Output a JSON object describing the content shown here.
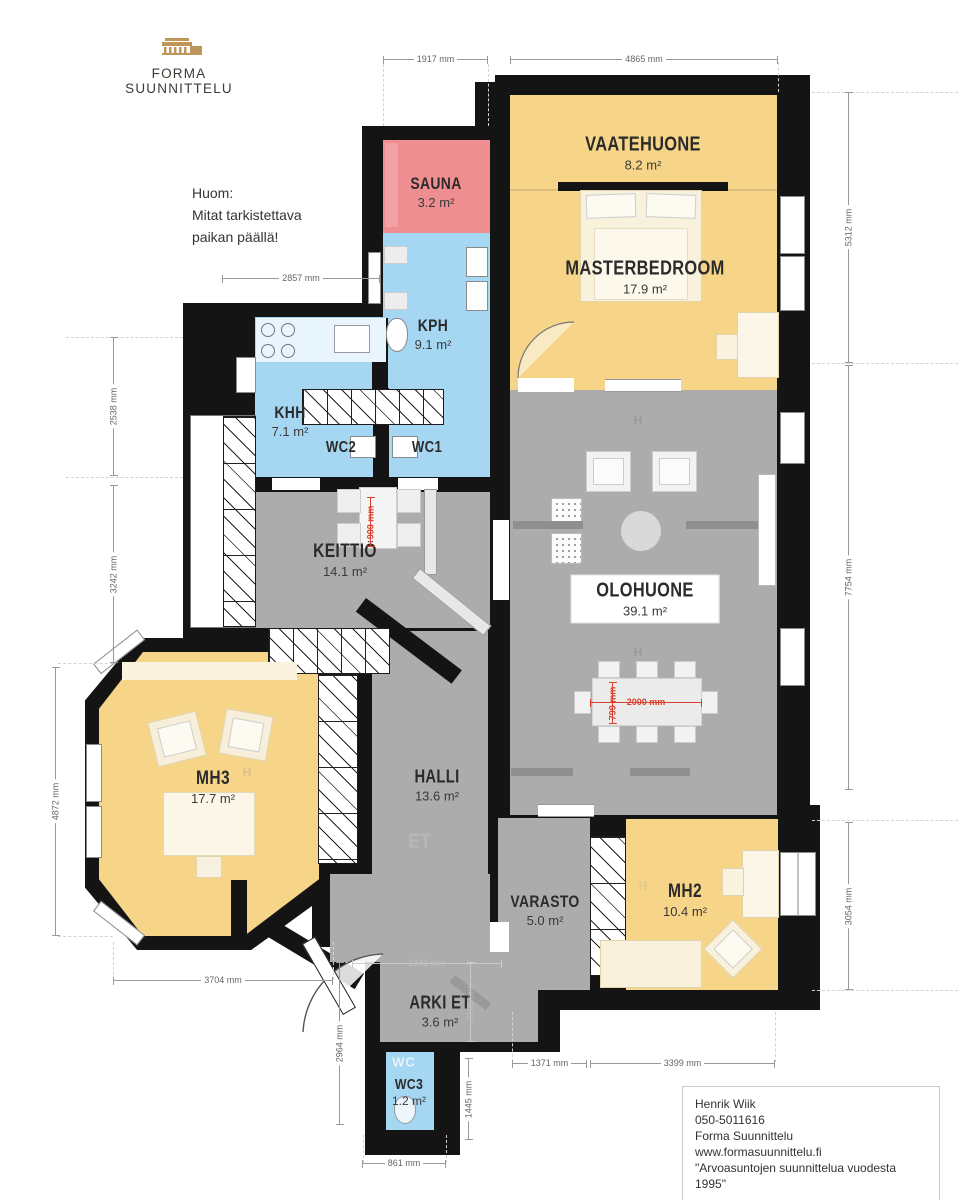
{
  "brand": {
    "logo_text": "FORMA SUUNNITTELU"
  },
  "note": {
    "lines": [
      "Huom:",
      "Mitat tarkistettava",
      "paikan päällä!"
    ]
  },
  "rooms": {
    "sauna": {
      "name": "SAUNA",
      "area": "3.2 m²"
    },
    "vaatehuone": {
      "name": "VAATEHUONE",
      "area": "8.2 m²"
    },
    "masterbedroom": {
      "name": "MASTERBEDROOM",
      "area": "17.9 m²"
    },
    "kph": {
      "name": "KPH",
      "area": "9.1 m²"
    },
    "khh": {
      "name": "KHH",
      "area": "7.1 m²"
    },
    "wc2": {
      "name": "WC2"
    },
    "wc1": {
      "name": "WC1"
    },
    "keittio": {
      "name": "KEITTIÖ",
      "area": "14.1 m²"
    },
    "olohuone": {
      "name": "OLOHUONE",
      "area": "39.1 m²"
    },
    "mh3": {
      "name": "MH3",
      "area": "17.7 m²"
    },
    "halli": {
      "name": "HALLI",
      "area": "13.6 m²"
    },
    "varasto": {
      "name": "VARASTO",
      "area": "5.0 m²"
    },
    "mh2": {
      "name": "MH2",
      "area": "10.4 m²"
    },
    "arkiet": {
      "name": "ARKI ET",
      "area": "3.6 m²"
    },
    "wc3": {
      "name": "WC3",
      "area": "1.2 m²"
    }
  },
  "markers": {
    "h": "H",
    "et": "ET",
    "wc": "WC"
  },
  "dims": {
    "top_sauna": "1917 mm",
    "top_master": "4865 mm",
    "khh_width": "2857 mm",
    "left_upper": "2538 mm",
    "left_mid": "3242 mm",
    "left_mh3": "4872 mm",
    "right_upper": "5312 mm",
    "right_mid": "7754 mm",
    "right_mh2": "3054 mm",
    "bottom_mh3": "3704 mm",
    "entry_height": "2964 mm",
    "wc3_height": "1445 mm",
    "bottom_wc3": "861 mm",
    "bottom_varasto": "1371 mm",
    "bottom_mh2": "3399 mm",
    "arki_width": "1843 mm",
    "arki_height": "2195 mm"
  },
  "red_dims": {
    "kitchen_clearance": "900 mm",
    "table_length": "2000 mm",
    "table_width": "799 mm"
  },
  "footer": {
    "lines": [
      "Henrik Wiik",
      "050-5011616",
      "Forma Suunnittelu",
      "www.formasuunnittelu.fi",
      "\"Arvoasuntojen suunnittelua vuodesta 1995\""
    ]
  },
  "colors": {
    "bedroom_yellow": "#F6D488",
    "wet_blue": "#A5D6F2",
    "sauna_pink": "#EF8E90",
    "living_gray": "#ACACAC",
    "wall_black": "#141414",
    "dim_red": "#D9402C",
    "brand_gold": "#C09559"
  }
}
